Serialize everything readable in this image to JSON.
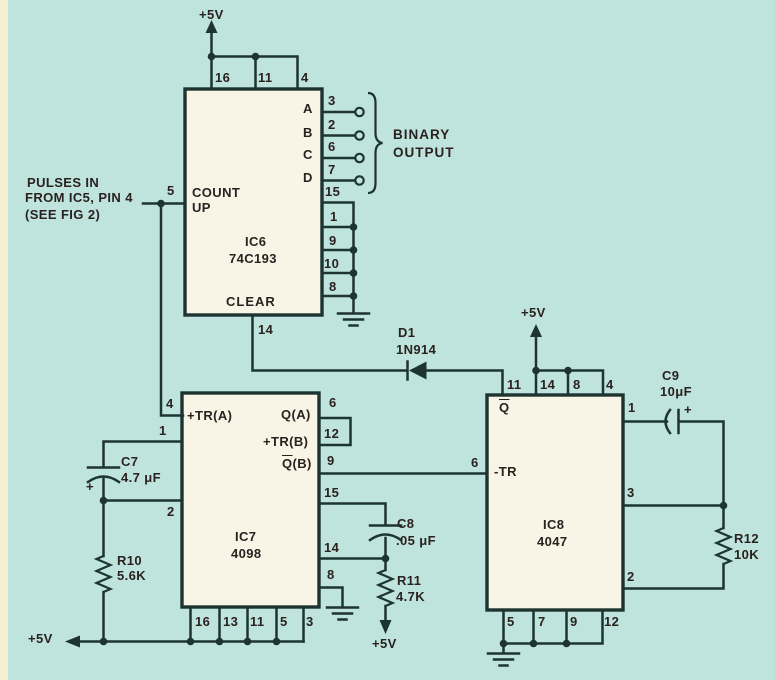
{
  "colors": {
    "background": "#bee4dd",
    "ink": "#1d3431",
    "text": "#2b211f",
    "ic_body": "#f8f5e7",
    "edge_strip": "#f5efd2"
  },
  "power_labels": {
    "top": "+5V",
    "ic8": "+5V",
    "bottom_left": "+5V",
    "r11": "+5V"
  },
  "input_note": {
    "line1": "PULSES IN",
    "line2": "FROM IC5, PIN 4",
    "line3": "(SEE FIG 2)"
  },
  "binary_output": {
    "line1": "BINARY",
    "line2": "OUTPUT"
  },
  "ic6": {
    "ref": "IC6",
    "part": "74C193",
    "count_label_1": "COUNT",
    "count_label_2": "UP",
    "clear_label": "CLEAR",
    "pin_top_16": "16",
    "pin_top_11": "11",
    "pin_top_4": "4",
    "pin_5": "5",
    "out_a": "A",
    "out_a_pin": "3",
    "out_b": "B",
    "out_b_pin": "2",
    "out_c": "C",
    "out_c_pin": "6",
    "out_d": "D",
    "out_d_pin": "7",
    "pin_15": "15",
    "pin_1": "1",
    "pin_9": "9",
    "pin_10": "10",
    "pin_8": "8",
    "pin_14": "14"
  },
  "d1": {
    "ref": "D1",
    "part": "1N914"
  },
  "ic7": {
    "ref": "IC7",
    "part": "4098",
    "tra_label": "+TR(A)",
    "qa_label": "Q(A)",
    "trb_label": "+TR(B)",
    "qb_label_q": "Q",
    "qb_label_suffix": "(B)",
    "pin_4": "4",
    "pin_1": "1",
    "pin_2": "2",
    "pin_6": "6",
    "pin_12": "12",
    "pin_9": "9",
    "pin_15": "15",
    "pin_14": "14",
    "pin_8": "8",
    "pin_16": "16",
    "pin_13": "13",
    "pin_11": "11",
    "pin_5": "5",
    "pin_3": "3"
  },
  "ic8": {
    "ref": "IC8",
    "part": "4047",
    "q_label": "Q",
    "tr_label": "-TR",
    "pin_11": "11",
    "pin_14": "14",
    "pin_8": "8",
    "pin_4": "4",
    "pin_1": "1",
    "pin_3": "3",
    "pin_2": "2",
    "pin_6": "6",
    "pin_5": "5",
    "pin_7": "7",
    "pin_9": "9",
    "pin_12": "12"
  },
  "c7": {
    "ref": "C7",
    "value": "4.7 μF",
    "polarity": "+"
  },
  "c8": {
    "ref": "C8",
    "value": ".05 μF"
  },
  "c9": {
    "ref": "C9",
    "value": "10μF",
    "polarity": "+"
  },
  "r10": {
    "ref": "R10",
    "value": "5.6K"
  },
  "r11": {
    "ref": "R11",
    "value": "4.7K"
  },
  "r12": {
    "ref": "R12",
    "value": "10K"
  }
}
